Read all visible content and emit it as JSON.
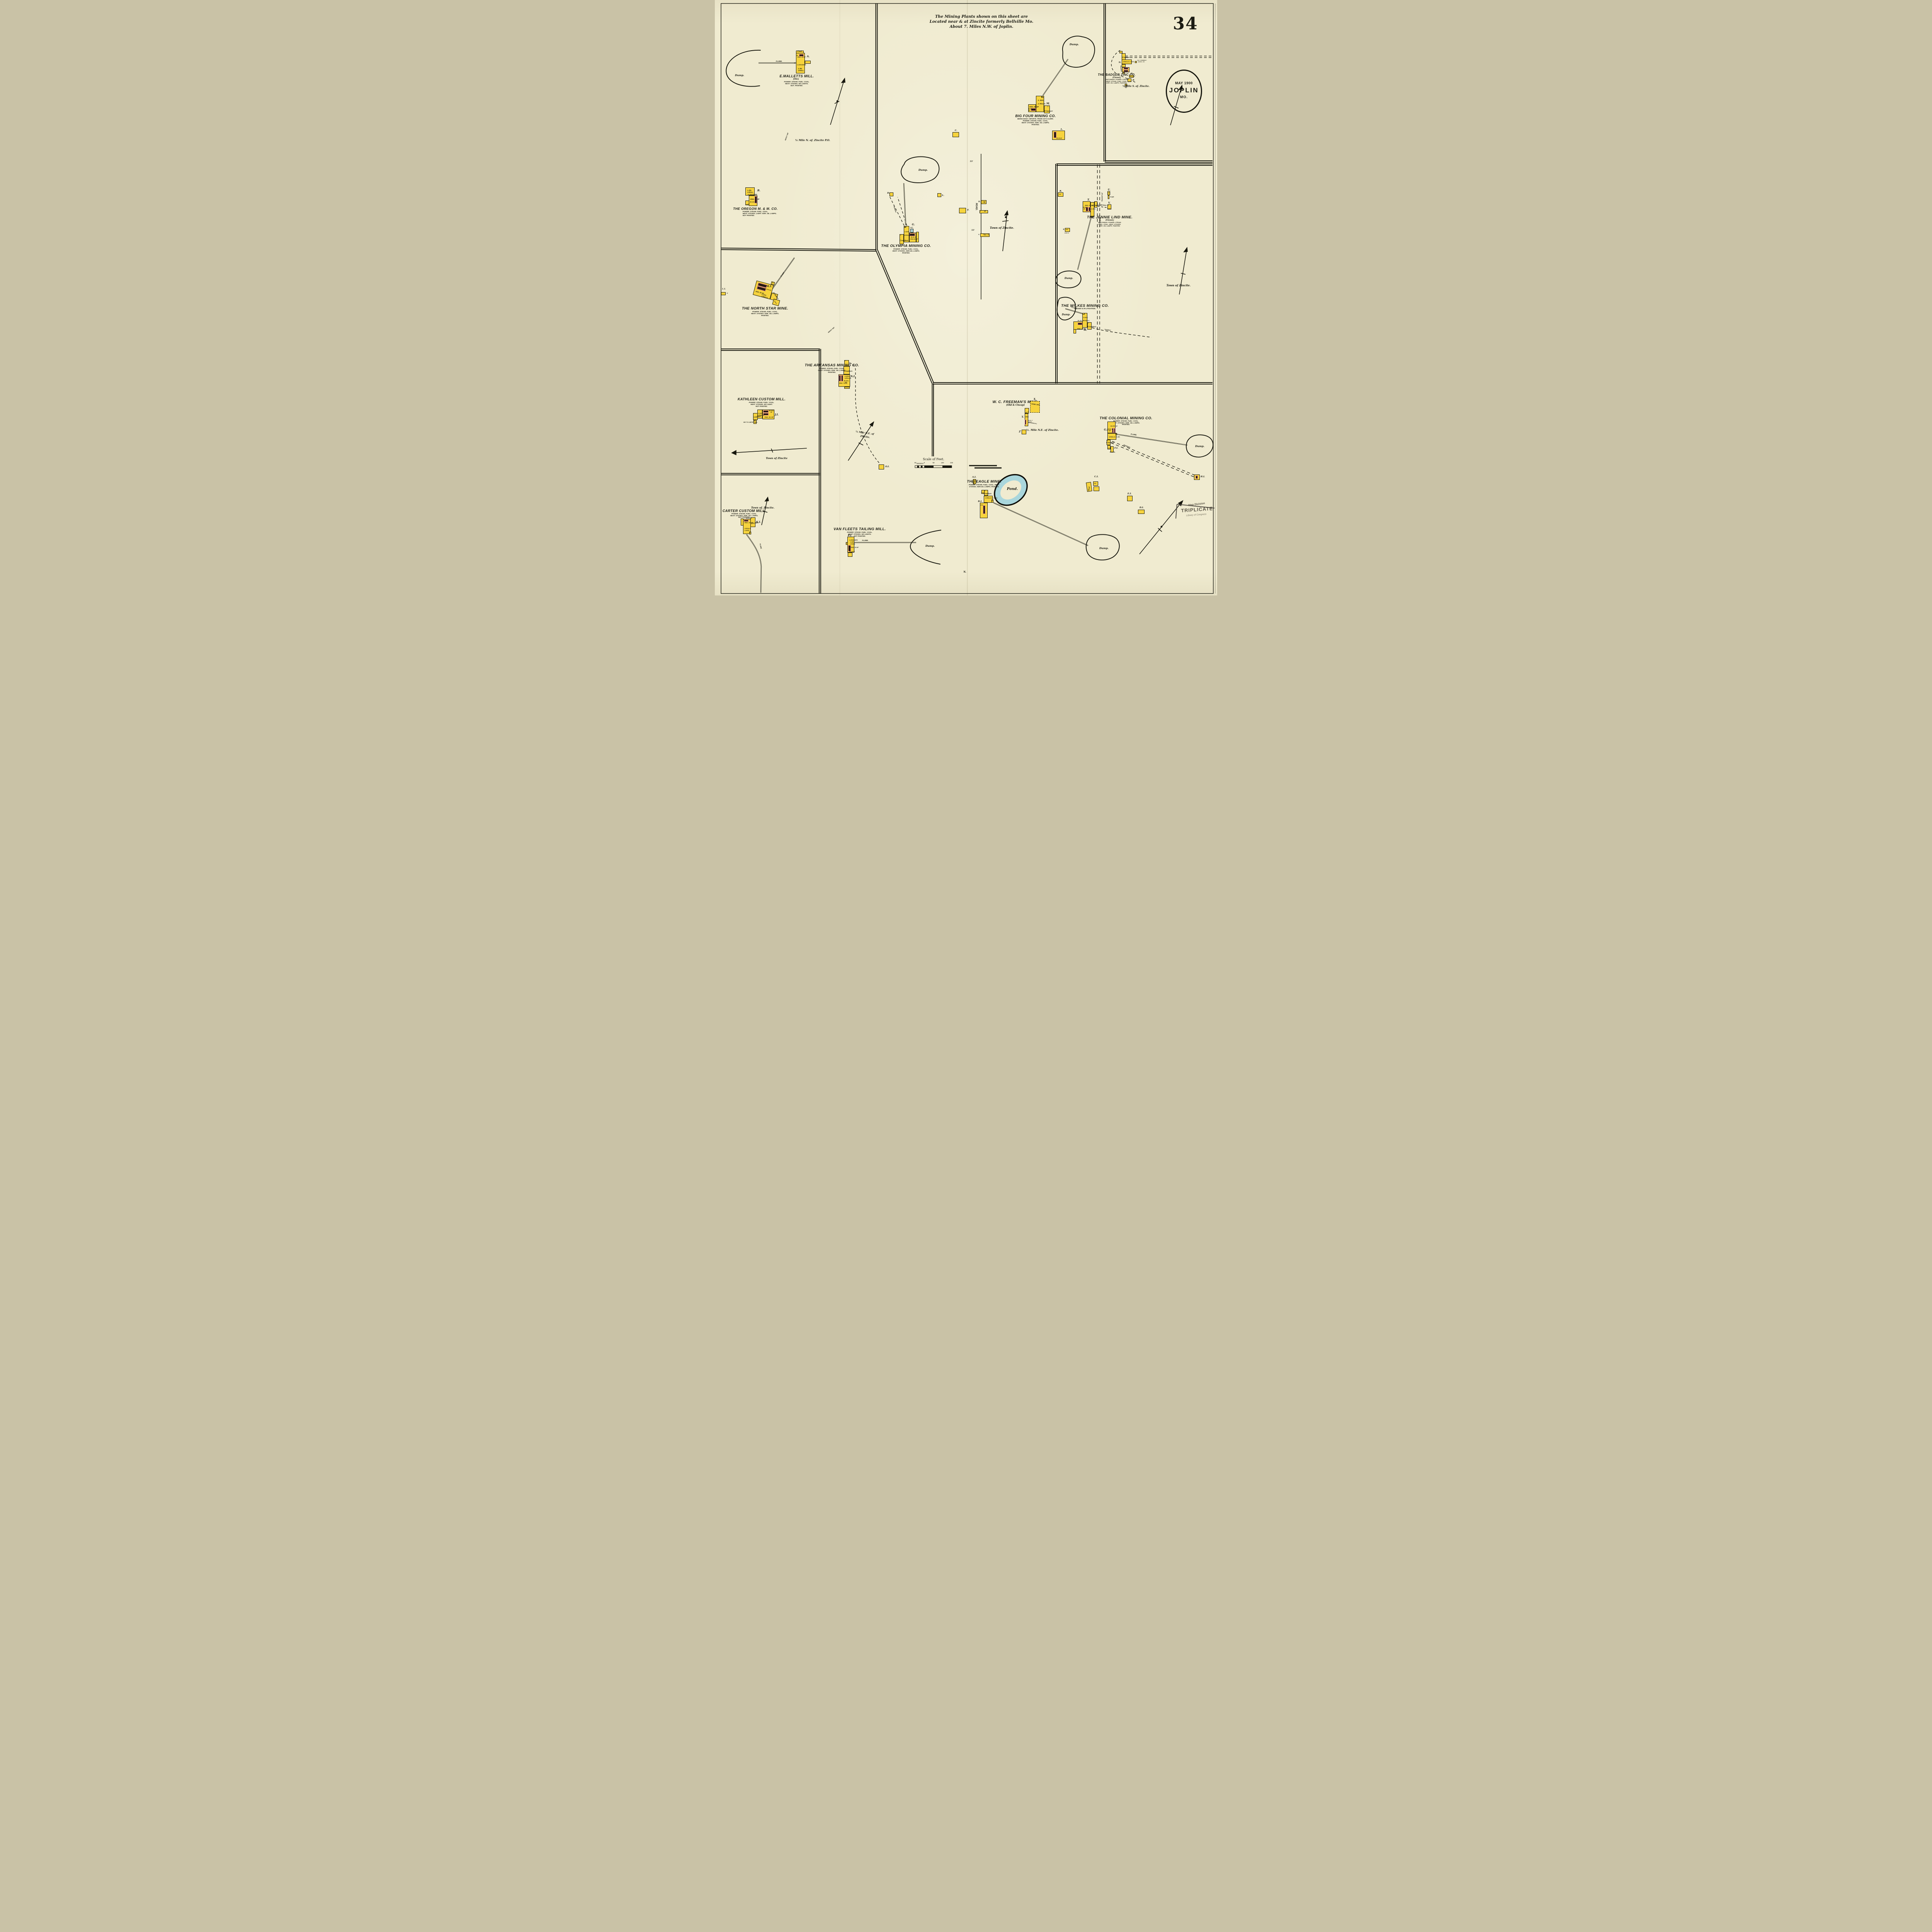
{
  "sheet": {
    "number": "34",
    "oval": {
      "date": "MAY 1900",
      "city": "JOPLIN",
      "state": "MO."
    },
    "note": [
      "The Mining Plants shown on this sheet are",
      "Located near & at Zincite formerly Bellville Mo.",
      "About 7. Miles N.W. of Joplin."
    ],
    "scale": {
      "title": "Scale of Feet.",
      "ticks": [
        "50",
        "40",
        "30",
        "20",
        "10",
        "0",
        "50",
        "100",
        "150"
      ]
    },
    "stamp": {
      "division": "Map Division",
      "triplicate": "TRIPLICATE",
      "library": "Library of Congress"
    },
    "engraver_mark": "N."
  },
  "labels": {
    "flume": "FLUME.",
    "dump": "Dump.",
    "tramway": "TRAMWAY",
    "road": "ROAD.",
    "drive": "Drive.",
    "planked": "(PLANKED)",
    "town": "Town of Zincite.",
    "town_nd": "Town of Zincite",
    "fifty_five": "55'"
  },
  "road_bldgs": {
    "k": "K.",
    "off": "Off.",
    "j": "J.",
    "d": "D",
    "h": "H.",
    "vac": "Vac. S."
  },
  "sites": {
    "malletts": {
      "title": "E.MALLETTS MILL.",
      "sub": "(Old.)",
      "info": [
        "POWER: STEAM. FUEL: COAL.",
        "HEAT: STOVES. NO LIGHTS.",
        "NOT. PAINTED."
      ],
      "letter": "A.",
      "coal": "Coal.",
      "eng": "ENG. 25 HP",
      "dim30": "30'",
      "dim40": "40'",
      "crusher": "1.CRUSHER.",
      "jig": "1.JIG.",
      "roll": "1.ROLL.",
      "note": "¼ Mile N. of. Zincite P.O.",
      "about": "ABOUT 160'"
    },
    "oregon": {
      "title": "THE OREGON M. & M. CO.",
      "info": [
        "POWER: STEAM. FUEL: COAL.",
        "HEAT: STOVES. LIGHT: KER. OIL LAMPS.",
        "NOT PAINTED."
      ],
      "letter": "B.",
      "jig": "1.JIG.",
      "roll": "1.ROLL.",
      "crusher": "1.CRUSHER.",
      "eng": "ENG. 25 HP",
      "irch": "IR.CH.25'",
      "shaft": "SHAFT"
    },
    "bigfour": {
      "title": "BIG FOUR MINING CO.",
      "info": [
        "BEING BUILT. INFOR'N. FROM CO'S CLERK.",
        "POWER: STEAM. FUEL: COAL.",
        "HEAT: STOVES. KER. OIL LAMPS.",
        "PAINTED."
      ],
      "letter": "M.",
      "jigs": "2. JIGS.",
      "rolls": "2. ROLLS.",
      "eng": "ENG. 40. HP",
      "irch": "IR.CH.",
      "dim30": "30'",
      "dim80": "80'",
      "crusher": "Crusher",
      "two": "2",
      "c_letter": "C.",
      "l_letter": "L.",
      "l_irch": "IR.CH.30'"
    },
    "badger": {
      "title": "THE BADGER ZINC CO.",
      "sub": "(Closed.)",
      "info": [
        "WATCHMAN. POWER: STEAM",
        "HEAT: STOVE. FUEL: COAL.",
        "KER. OIL LAMPS. PAINTED."
      ],
      "letter": "N.",
      "crusher": "Crusher",
      "rolls_jigs": "3.ROLLS. 2.JIGS.",
      "irch": "IR.CH'S. 30'",
      "vac1": "VAC. FORMERLY",
      "vac2": "GASOL. HO.",
      "o": "O.",
      "blsm": "Bl.Sm.",
      "p": "P.",
      "two": "2",
      "shaft": "SHAFT.",
      "q": "Q.",
      "oil": "OIL",
      "note": "¼ Mile S. of. Zincite."
    },
    "olympia": {
      "title": "THE OLYMPIA MINING CO.",
      "info": [
        "POWER: STEAM. FUEL: COAL.",
        "HEAT: STOVES. KER.OIL LAMPS.",
        "PAINTED."
      ],
      "letter": "G.",
      "wt": "W.T.",
      "jigs": "2.JIGS.",
      "rolls": "3.ROLLS.",
      "crusher": "Crusher.",
      "two": "2",
      "irch": "IR.CH. 35'",
      "eng": "ENG.60.HP",
      "dim60": "60'",
      "d": "D.",
      "l": "L.",
      "f": "F."
    },
    "jennielind": {
      "title": "THE JENNIE LIND MINE.",
      "sub": "(Closed.)",
      "info": [
        "WATCHMAN. POWER: STEAM.",
        "FUEL: COAL. HEAT: STOVES.",
        "KER. OIL LAMPS. PAINTED."
      ],
      "letter": "T.",
      "eng": "ENG. 65. HP",
      "irchs": "IR.CH'S.",
      "dim30": "30'",
      "rolls": "3.ROLLS.",
      "jigs": "2.JIGS.",
      "crusher": "Crusher",
      "two": "2",
      "dim60": "60'",
      "u": "U.",
      "u_eng": "ENG.",
      "pump": "PUMP.",
      "v": "V.",
      "shaft": "SHAFT.",
      "r": "R.",
      "oil": "OIL",
      "s": "S",
      "off": "OFF.",
      "how_d": "HOW. D."
    },
    "northstar": {
      "title": "THE NORTH STAR MINE.",
      "info": [
        "POWER: STEAM. FUEL: COAL.",
        "HEAT: STOVES: KER. OIL LAMPS.",
        "PAINTED."
      ],
      "letter": "M.I.",
      "eng": "ENG. 50 HP",
      "irchs": "IR.CH'S 30'",
      "jigs": "2.JIGS.",
      "rolls": "2.ROLLS.",
      "crusher": "Crusher",
      "shaft": "SHAFT",
      "two": "2",
      "dim60": "60'",
      "li": "L.I.",
      "li_d": "D.",
      "about": "ABOUT 400'"
    },
    "wilkes": {
      "title": "THE WILKES MINING CO.",
      "sub": "CLOSED & IN LITIGATION.",
      "letter": "W.",
      "jigs": "2.JIGS.",
      "rolls": "2.ROLLS.",
      "irch": "IR. CH. 35'",
      "eng": "ENG. 35 HP",
      "crusher": "Crusher.",
      "two": "2"
    },
    "arkansas": {
      "title": "THE ARKANSAS MINING CO.",
      "info": [
        "POWER: STEAM. FUEL: COAL.",
        "HEAT: STOVES. KER. OIL LAMPS.",
        "PAINTED."
      ],
      "letter": "N.I.",
      "shaft": "SHAFT.",
      "two": "2",
      "crusher": "Crusher.",
      "jigs": "2.JIGS.",
      "rolls": "3.ROLLS.",
      "irchs": "IR.CH'S.",
      "dim40": "40'",
      "eng": "ENG. 75 HP",
      "oi": "O.I.",
      "note1": "¼ Mile N.E. of",
      "note2": "Zincite."
    },
    "kathleen": {
      "title": "KATHLEEN CUSTOM MILL.",
      "info": [
        "POWER: STEAM. FUEL: COAL.",
        "HEAT: STOVES. NO LIGHT.",
        "NOT PAINTED."
      ],
      "letter": "J.I.",
      "jigs": "2.JIGS",
      "rolls": "2.ROLLS.",
      "crusher": "Crusher",
      "eng": "ENG. 25. HP",
      "irchs": "IR.CH'S.",
      "dim40": "40'",
      "two": "2",
      "carter_note": "880' TO CARTER MILL."
    },
    "carter": {
      "title": "CARTER CUSTOM MILL.",
      "info": [
        "POWER: STEAM. FUEL: COAL.",
        "HEAT: STOVES. KER. OIL LAMPS.",
        "NOT PAINTED."
      ],
      "letter": "K.I.",
      "irch": "IR.CH. 20'",
      "eng": "ENG. 20. HP",
      "ore_ho": "Ore Ho.",
      "rolls": "2.ROLLS.",
      "jigs": "2.JIGS.",
      "dim40": "40'",
      "town": "Town of. Zincite."
    },
    "vanfleets": {
      "title": "VAN FLEETS TAILING MILL.",
      "info": [
        "POWER: STEAM. FUEL: COAL.",
        "HEAT: STOVES. NO LIGHTS.",
        "NOT PAINTED."
      ],
      "letter": "P.I.",
      "crusher": "1.CRUSHER.",
      "jig": "1.JIG.",
      "roll": "1.ROLL.",
      "eng": "ENG. 20 HP",
      "irch": "IR.CH.30'",
      "dim40": "40'"
    },
    "freeman": {
      "title": "W. C. FREEMAN'S MINE.",
      "sub": "(Old & Cheap)",
      "x": "X.",
      "hand_jigs": "HAND JIGS.",
      "y": "Y.",
      "shaft": "SHAFT.",
      "eng": "ENG.",
      "irch": "IR.CH. 2'",
      "abrf": "AB.RF.",
      "dangerous": "(DANGEROUS.)",
      "z": "Z",
      "note": "½. Mile N.E. of Zincite."
    },
    "colonial": {
      "title": "THE COLONIAL MINING CO.",
      "info": [
        "POWER: STEAM. FUEL: COAL.",
        "HEAT: STOVES. KER. OIL LAMPS.",
        "PAINTED."
      ],
      "letter": "G.I.",
      "eng1": "ENG. 80",
      "eng2": "HP",
      "irchs": "IR.CH'S. 30'",
      "rolls_jig": "3.ROLLS. 2.JIG.",
      "dim60": "60",
      "crusher": "Crusher.",
      "two": "2",
      "shaft": "SHAFT.",
      "fi": "F.I.",
      "blsm": "Bl.Sm.",
      "ci": "C.I.",
      "shed": "Shed",
      "off": "OFF.",
      "ei": "E.I.",
      "di": "D.I.",
      "hi": "H.I."
    },
    "eagle": {
      "title": "THE EAGLE MINE.",
      "info": [
        "POWER: STEAM. FUEL: COAL. HEAT:",
        "STOVES. KER.OIL LAMPS. PAINTED."
      ],
      "ai": "A.I.",
      "blsm": "Bl.Sm.",
      "shaft": "SHAFT.",
      "crusher": "Crusher.",
      "two": "2",
      "rolls_jigs": "2.ROLLS. 2.JIGS.",
      "dim60": "60'",
      "bi": "B.I.",
      "eng": "ENG.",
      "pond": "Pond."
    }
  }
}
